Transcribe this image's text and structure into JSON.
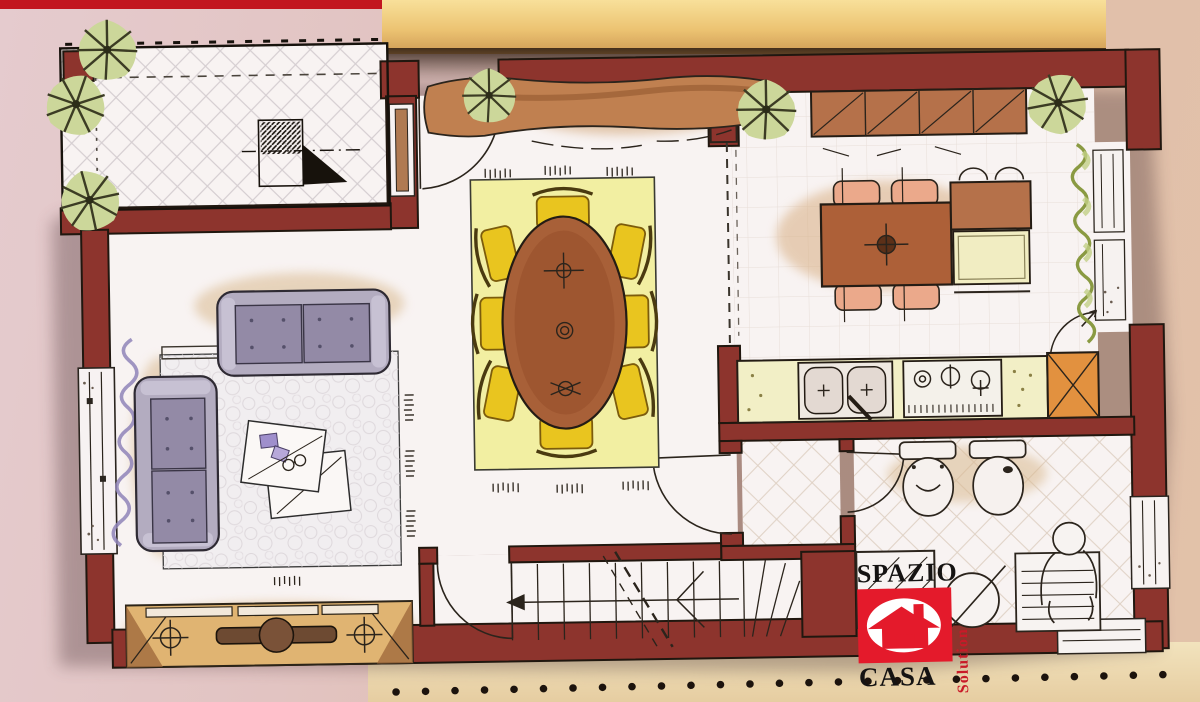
{
  "photo": {
    "background_left": "#e2c6c8",
    "background_right": "#dfbda6",
    "top_strip_color": "#c2161f",
    "top_band_colors": [
      "#f7dc90",
      "#d9a75e"
    ],
    "bottom_band_color": "#eeddb6",
    "dot_color": "#1c130d",
    "dot_count": 28
  },
  "logo": {
    "line1": "SPAZIO",
    "line2": "CASA",
    "line3": "Solution",
    "accent_color": "#e41a2b",
    "text_color": "#151312"
  },
  "plan": {
    "wall_color": "#8d342d",
    "floor_color": "#f8f3f2",
    "ink_color": "#2b241c",
    "rooms": [
      {
        "name": "terrace",
        "features": [
          "tiled-floor",
          "red-planter",
          "corner-plants",
          "north-arrow",
          "dashed-boundary"
        ]
      },
      {
        "name": "living-room",
        "features": [
          "three-seat-sofa",
          "two-seat-sofa",
          "pebble-rug",
          "two-coffee-tables",
          "curtained-window",
          "tv-sideboard",
          "speakers"
        ]
      },
      {
        "name": "dining-area",
        "features": [
          "oval-table",
          "eight-yellow-chairs",
          "yellow-rug",
          "console-sideboard",
          "plant-on-console",
          "terrace-door"
        ]
      },
      {
        "name": "kitchen",
        "features": [
          "wall-cabinets",
          "table-with-four-chairs",
          "island-cabinet",
          "double-sink",
          "four-burner-hob",
          "tall-corner-unit",
          "corner-plants",
          "balcony-door"
        ]
      },
      {
        "name": "balcony",
        "features": [
          "climbing-plant",
          "french-windows"
        ]
      },
      {
        "name": "hallway",
        "features": [
          "door-to-living",
          "door-to-bathroom",
          "diagonal-tiles"
        ]
      },
      {
        "name": "bathroom",
        "features": [
          "toilet",
          "bidet",
          "shower",
          "round-basin",
          "bathtub-with-figure",
          "side-window"
        ]
      },
      {
        "name": "staircase",
        "features": [
          "treads",
          "winders",
          "direction-arrow",
          "entry-door",
          "dashed-cut-line"
        ]
      }
    ],
    "furniture_colors": {
      "sofa": "#b2abbf",
      "chair_yellow": "#e9c51f",
      "wood_brown": "#a86038",
      "cabinet_tan": "#e0b472",
      "counter": "#f2efc6",
      "appliance_orange": "#e2913f",
      "plant_green": "#b9c87e",
      "curtain_purple": "#8f84b8"
    }
  }
}
